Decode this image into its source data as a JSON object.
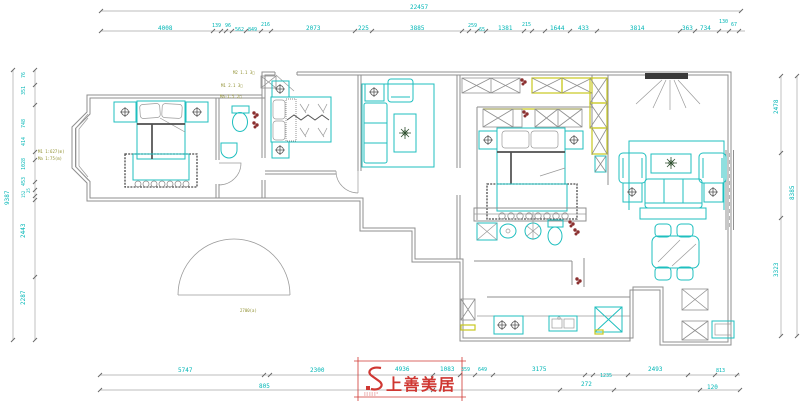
{
  "colors": {
    "dim_text": "#00b6b6",
    "furniture": "#1fbfbf",
    "cabinet_accent": "#c9c920",
    "wall": "#8f8f8f",
    "annotation": "#8f8f2f",
    "flower": "#8b3030",
    "logo_red": "#cf3732"
  },
  "logo": {
    "name": "上善美居"
  },
  "svg_texts": [
    {
      "t": "22457",
      "x": 410,
      "y": 9
    },
    {
      "t": "4008",
      "x": 158,
      "y": 30
    },
    {
      "t": "139",
      "x": 212,
      "y": 27,
      "s": 5
    },
    {
      "t": "96",
      "x": 225,
      "y": 27,
      "s": 5
    },
    {
      "t": "562",
      "x": 235,
      "y": 31,
      "s": 5
    },
    {
      "t": "849",
      "x": 248,
      "y": 31,
      "s": 5
    },
    {
      "t": "216",
      "x": 261,
      "y": 26,
      "s": 5
    },
    {
      "t": "2073",
      "x": 306,
      "y": 30
    },
    {
      "t": "225",
      "x": 358,
      "y": 30
    },
    {
      "t": "3885",
      "x": 410,
      "y": 30
    },
    {
      "t": "259",
      "x": 468,
      "y": 27,
      "s": 5
    },
    {
      "t": "65",
      "x": 479,
      "y": 31,
      "s": 5
    },
    {
      "t": "1381",
      "x": 498,
      "y": 30
    },
    {
      "t": "215",
      "x": 522,
      "y": 26,
      "s": 5
    },
    {
      "t": "1644",
      "x": 550,
      "y": 30
    },
    {
      "t": "433",
      "x": 578,
      "y": 30
    },
    {
      "t": "3814",
      "x": 630,
      "y": 30
    },
    {
      "t": "363",
      "x": 682,
      "y": 30
    },
    {
      "t": "734",
      "x": 700,
      "y": 30
    },
    {
      "t": "130",
      "x": 719,
      "y": 23,
      "s": 5
    },
    {
      "t": "67",
      "x": 731,
      "y": 26,
      "s": 5
    },
    {
      "t": "9387",
      "x": 9,
      "y": 205,
      "r": -90
    },
    {
      "t": "76",
      "x": 25,
      "y": 78,
      "r": -90,
      "s": 5
    },
    {
      "t": "351",
      "x": 25,
      "y": 95,
      "r": -90,
      "s": 5
    },
    {
      "t": "748",
      "x": 25,
      "y": 128,
      "r": -90,
      "s": 5
    },
    {
      "t": "414",
      "x": 25,
      "y": 146,
      "r": -90,
      "s": 5
    },
    {
      "t": "1028",
      "x": 25,
      "y": 170,
      "r": -90,
      "s": 5
    },
    {
      "t": "453",
      "x": 25,
      "y": 186,
      "r": -90,
      "s": 5
    },
    {
      "t": "25",
      "x": 30,
      "y": 193,
      "r": -90,
      "s": 4
    },
    {
      "t": "152",
      "x": 25,
      "y": 198,
      "r": -90,
      "s": 4
    },
    {
      "t": "2443",
      "x": 25,
      "y": 238,
      "r": -90
    },
    {
      "t": "2287",
      "x": 25,
      "y": 305,
      "r": -90
    },
    {
      "t": "2478",
      "x": 778,
      "y": 114,
      "r": -90
    },
    {
      "t": "3323",
      "x": 778,
      "y": 277,
      "r": -90
    },
    {
      "t": "8385",
      "x": 794,
      "y": 200,
      "r": -90
    },
    {
      "t": "5747",
      "x": 178,
      "y": 372
    },
    {
      "t": "2300",
      "x": 310,
      "y": 372
    },
    {
      "t": "4936",
      "x": 395,
      "y": 371
    },
    {
      "t": "1083",
      "x": 440,
      "y": 371
    },
    {
      "t": "359",
      "x": 461,
      "y": 371,
      "s": 5
    },
    {
      "t": "649",
      "x": 478,
      "y": 371,
      "s": 5
    },
    {
      "t": "3175",
      "x": 532,
      "y": 371
    },
    {
      "t": "1235",
      "x": 600,
      "y": 377,
      "s": 5
    },
    {
      "t": "2493",
      "x": 648,
      "y": 371
    },
    {
      "t": "813",
      "x": 716,
      "y": 372,
      "s": 5
    },
    {
      "t": "805",
      "x": 259,
      "y": 388
    },
    {
      "t": "272",
      "x": 581,
      "y": 386
    },
    {
      "t": "120",
      "x": 707,
      "y": 389
    },
    {
      "t": "M2 1.1 3□",
      "x": 233,
      "y": 74,
      "s": 4,
      "c": "#8f8f2f",
      "n": "cad-annotation"
    },
    {
      "t": "M1 2.1 3□",
      "x": 221,
      "y": 87,
      "s": 4,
      "c": "#8f8f2f",
      "n": "cad-annotation"
    },
    {
      "t": "Ma-1.5 2□",
      "x": 220,
      "y": 98,
      "s": 4,
      "c": "#8f8f2f",
      "n": "cad-annotation"
    },
    {
      "t": "M1 1:627(m)",
      "x": 38,
      "y": 153,
      "s": 4,
      "c": "#8f8f2f",
      "n": "cad-annotation"
    },
    {
      "t": "Ma 1:75(m)",
      "x": 38,
      "y": 160,
      "s": 4,
      "c": "#8f8f2f",
      "n": "cad-annotation"
    },
    {
      "t": "2700(a)",
      "x": 240,
      "y": 312,
      "s": 4,
      "c": "#8f8f2f",
      "n": "cad-annotation"
    }
  ]
}
